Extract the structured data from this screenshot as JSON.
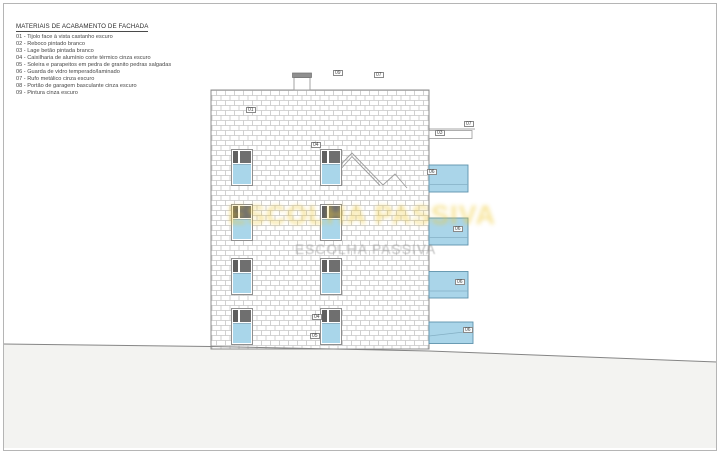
{
  "legend": {
    "title": "MATERIAIS DE ACABAMENTO DE FACHADA",
    "items": [
      "01 - Tijolo face à vista castanho escuro",
      "02 - Reboco pintado branco",
      "03 - Lage betão pintada branco",
      "04 - Caixilharia de alumínio corte térmico cinza escuro",
      "05 - Soleira e parapeitos em pedra de granito pedras salgadas",
      "06 - Guarda de vidro temperado/laminado",
      "07 - Rufo metálico cinza escuro",
      "08 - Portão de garagem basculante cinza escuro",
      "09 - Pintura cinza escuro"
    ]
  },
  "elevation": {
    "callouts": [
      {
        "ref": "09"
      },
      {
        "ref": "07"
      },
      {
        "ref": "01"
      },
      {
        "ref": "04"
      },
      {
        "ref": "07"
      },
      {
        "ref": "03"
      },
      {
        "ref": "06"
      },
      {
        "ref": "06"
      },
      {
        "ref": "06"
      },
      {
        "ref": "06"
      },
      {
        "ref": "04"
      },
      {
        "ref": "05"
      }
    ],
    "colors": {
      "glass": "#a9d6ea",
      "glass_border": "#5f93ac",
      "brick_joint": "#c6c6c6",
      "frame_dark": "#6f6f6f",
      "ground_fill": "#f3f3f1",
      "outline": "#8c8c8c",
      "watermark_yellow": "#eec72e"
    }
  },
  "watermark": {
    "primary": "ESCOLHA PASSIVA",
    "secondary": "ESCOLHA PASSIVA"
  }
}
